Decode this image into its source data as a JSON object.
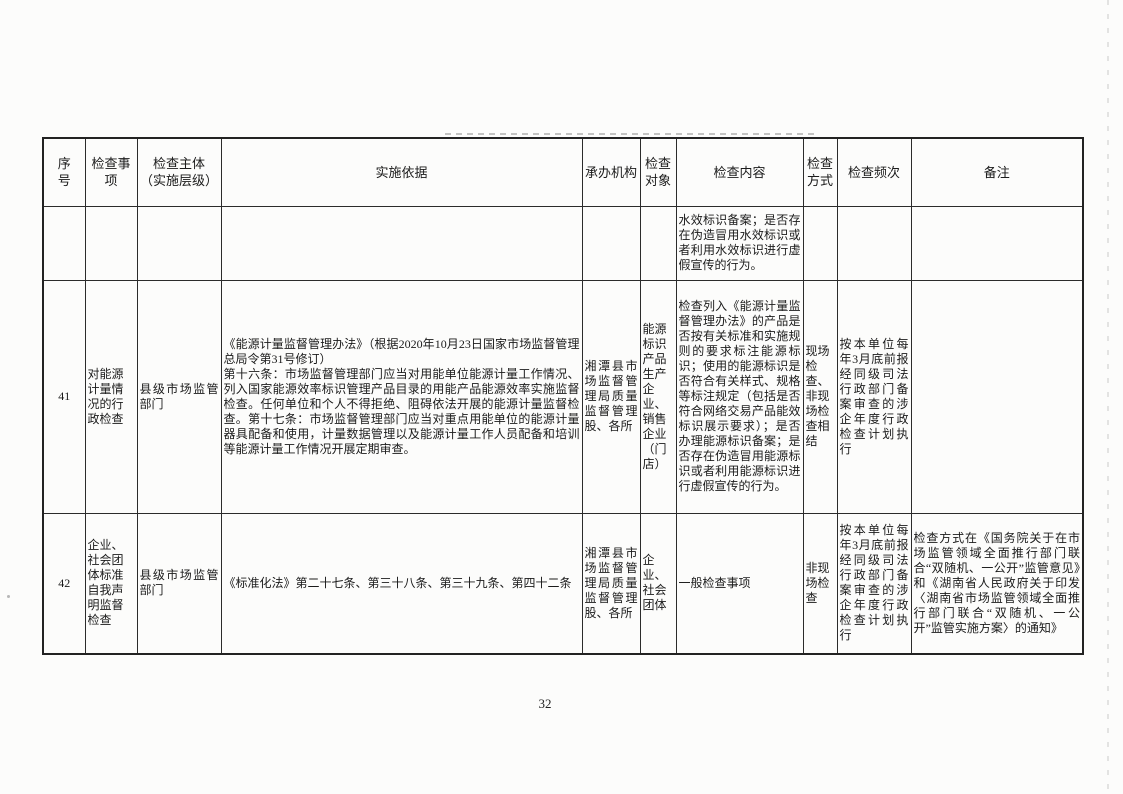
{
  "colors": {
    "paper": "#fcfcfb",
    "ink": "#1b1b1b",
    "border": "#2b2b2b"
  },
  "page": {
    "number": "32"
  },
  "table": {
    "headers": [
      "序\n号",
      "检查事项",
      "检查主体\n（实施层级）",
      "实施依据",
      "承办机构",
      "检查对象",
      "检查内容",
      "检查方式",
      "检查频次",
      "备注"
    ],
    "rows": [
      {
        "seq": "",
        "item": "",
        "subject": "",
        "basis": "",
        "agency": "",
        "target": "",
        "content": "水效标识备案；是否存在伪造冒用水效标识或者利用水效标识进行虚假宣传的行为。",
        "method": "",
        "frequency": "",
        "remark": ""
      },
      {
        "seq": "41",
        "item": "对能源计量情况的行政检查",
        "subject": "县级市场监管部门",
        "basis": "《能源计量监督管理办法》（根据2020年10月23日国家市场监督管理总局令第31号修订）\n第十六条：市场监督管理部门应当对用能单位能源计量工作情况、列入国家能源效率标识管理产品目录的用能产品能源效率实施监督检查。任何单位和个人不得拒绝、阻碍依法开展的能源计量监督检查。第十七条：市场监督管理部门应当对重点用能单位的能源计量器具配备和使用，计量数据管理以及能源计量工作人员配备和培训等能源计量工作情况开展定期审查。",
        "agency": "湘潭县市场监督管理局质量监督管理股、各所",
        "target": "能源标识产品生产企业、销售企业（门店）",
        "content": "检查列入《能源计量监督管理办法》的产品是否按有关标准和实施规则的要求标注能源标识；使用的能源标识是否符合有关样式、规格等标注规定（包括是否符合网络交易产品能效标识展示要求）；是否办理能源标识备案；是否存在伪造冒用能源标识或者利用能源标识进行虚假宣传的行为。",
        "method": "现场检查、非现场检查相结",
        "frequency": "按本单位每年3月底前报经同级司法行政部门备案审查的涉企年度行政检查计划执行",
        "remark": ""
      },
      {
        "seq": "42",
        "item": "企业、社会团体标准自我声明监督检查",
        "subject": "县级市场监管部门",
        "basis": "《标准化法》第二十七条、第三十八条、第三十九条、第四十二条",
        "agency": "湘潭县市场监督管理局质量监督管理股、各所",
        "target": "企业、社会团体",
        "content": "一般检查事项",
        "method": "非现场检查",
        "frequency": "按本单位每年3月底前报经同级司法行政部门备案审查的涉企年度行政检查计划执行",
        "remark": "检查方式在《国务院关于在市场监管领域全面推行部门联合“双随机、一公开”监管意见》和《湖南省人民政府关于印发〈湖南省市场监管领域全面推行部门联合“双随机、一公开”监管实施方案〉的通知》"
      }
    ]
  }
}
